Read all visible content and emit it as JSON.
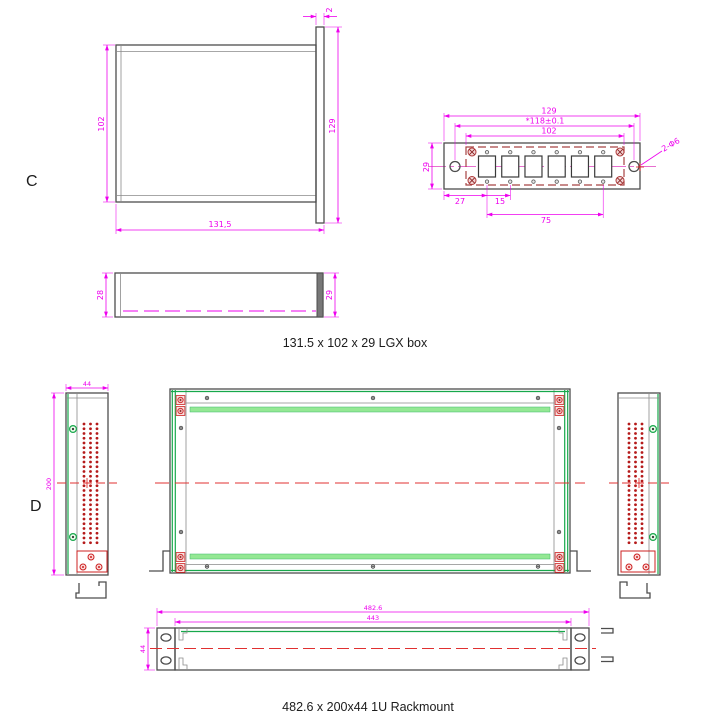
{
  "labels": {
    "section_c": "C",
    "section_d": "D"
  },
  "captions": {
    "lgx_box": "131.5 x 102 x 29 LGX box",
    "rackmount": "482.6 x 200x44 1U Rackmount"
  },
  "lgx": {
    "top_view": {
      "height": "102",
      "flange_height": "129",
      "flange_thickness": "2",
      "width": "131,5"
    },
    "side_view": {
      "body_height": "28",
      "flange_height": "29"
    },
    "faceplate": {
      "overall_width": "129",
      "hole_spacing": "*118±0.1",
      "cutout_span": "102",
      "height": "29",
      "edge_to_first": "27",
      "pitch": "15",
      "port_span": "75",
      "hole_note": "2-Φ6"
    }
  },
  "rackmount": {
    "side_panel": {
      "depth": "44",
      "height": "200"
    },
    "front_view": {
      "overall_width": "482.6",
      "inner_width": "443",
      "height": "44"
    }
  },
  "colors": {
    "dimension": "#ee00ee",
    "outline": "#4d4d4d",
    "green": "#17a84b",
    "light_green": "#94e894",
    "red": "#cc2020",
    "dark_red": "#a84444",
    "centerline_red": "#e03030"
  }
}
